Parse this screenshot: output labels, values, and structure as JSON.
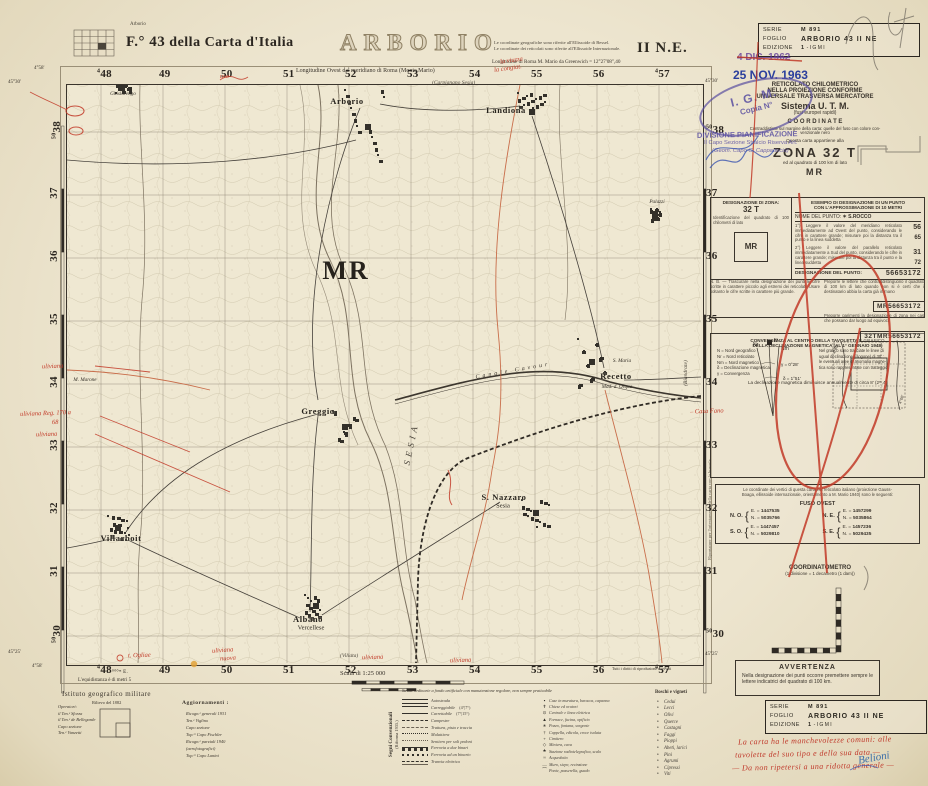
{
  "header": {
    "logo_label": "Arborio",
    "sheet_f": "F.° 43",
    "sheet_ref": "della Carta d'Italia",
    "title": "ARBORIO",
    "quadrant": "II N.E.",
    "note1": "Le coordinate geografiche sono riferite all'Ellissoide di Bessel.",
    "note2": "Le coordinate dei reticolati sono riferite all'Ellissoide Internazionale.",
    "lon_west": "Longitudine Ovest dal meridiano di Roma (Monte Mario)",
    "longitude": "Longitudine di Roma M. Mario da Greenwich = 12°27'08\",40"
  },
  "series_box": {
    "serie_label": "SERIE",
    "serie_value": "M 891",
    "foglio_label": "FOGLIO",
    "foglio_value": "ARBORIO 43 II NE",
    "edizione_label": "EDIZIONE",
    "edizione_value": "1",
    "edizione_suffix": "- I G M I"
  },
  "stamps": {
    "date_old": "4 DIC. 1962",
    "date_new": "25 NOV. 1963",
    "oval1": "I. G. M.",
    "oval2": "Copia N°",
    "divisione": "DIVISIONE PIANIFICAZIONE",
    "capo": "Il Capo Sezione Stralcio Riserva Art.",
    "firma": "(Geom. Capo C. Cappadocia)"
  },
  "utm_block": {
    "l1": "RETICOLATO CHILOMETRICO",
    "l2": "NELLA PROIEZIONE CONFORME",
    "l3": "UNIVERSALE TRASVERSA MERCATORE",
    "l4": "Sistema U. T. M.",
    "l5": "(fusi europei rapidi)",
    "l6": "C O O R D I N A T E",
    "l7": "Contraddistinte sul margine della carta: quelle del fuso con colore con-",
    "l8": "venzionale nero",
    "l9": "Questa carta appartiene alla",
    "zona": "ZONA 32 T",
    "sub": "ed al quadrato di 100 km di lato",
    "square": "MR"
  },
  "designation": {
    "h_left1": "DESIGNAZIONE DI ZONA:",
    "h_left2": "32 T",
    "h_left3": "Identificazione del quadrato di 100 chilometri di lato",
    "square": "MR",
    "h_right1": "ESEMPIO DI DESIGNAZIONE DI UN PUNTO",
    "h_right2": "CON L'APPROSSIMAZIONE DI 10 METRI",
    "nome_label": "NOME DEL PUNTO:",
    "nome_value": "✶ S.ROCCO",
    "p1": "1°) Leggere il valore del meridiano reticolato immediatamente ad Ovest del punto, considerando le cifre in carattere grande; misurare poi la distanza tra il punto e la linea suddetta",
    "p2": "2°) Leggere il valore del parallelo reticolato immediatamente a Sud del punto, considerando le cifre in carattere grande; misurare poi la distanza tra il punto e la linea suddetta",
    "n1": "56",
    "n2": "65",
    "n3": "31",
    "n4": "72",
    "res_label": "DESIGNAZIONE DEL PUNTO:",
    "res_value": "56653172",
    "nb": "N. B. — Trascurare nella designazione dei punti le cifre scritte in carattere piccolo agli estremi dei reticolati. Usare soltanto le cifre scritte in carattere più grande.",
    "nb1": "Preporre le lettere che contraddistinguono il quadrato di 100 km di lato quando non si è certi che il destinatario abbia la carta già in mano",
    "val1": "MR56653172",
    "nb2": "Preporre parimenti la designazione di zona nei casi che possano dar luogo ad equivoci",
    "val2": "32TMR56653172"
  },
  "declination": {
    "title1": "CONVERGENZA AL CENTRO DELLA TAVOLETTA E GRAFICO",
    "title2": "DELLA DECLINAZIONE MAGNETICA (AL 1° GENNAIO 1948)",
    "n_label": "N",
    "nr_label": "Nr",
    "nm_label": "Nm",
    "delta": "δ = 1°51'",
    "gamma": "γ = 0°28'",
    "chart_l1": "4°30'",
    "chart_l2": "4°00'",
    "legend_lines": [
      "N   =  Nord geografico",
      "Nr  =  Nord reticolato",
      "Nm =  Nord magnetico",
      "δ   =  Declinazione magnetica",
      "γ   =  Convergenza"
    ],
    "note_lines": [
      "Nel grafico sono tracciate le linee di",
      "ugual declinazione (isogone) di 30' ;",
      "le eventuali aree di anomalia magne-",
      "tica sono rappresentate con tratteggio."
    ],
    "bottom": "La declinazione magnetica diminuisce annualmente di circa 8' (2ᵐ,4)"
  },
  "fuso": {
    "intro1": "Le coordinate dei vertici di questa carta nel reticolato italiano (proiezione Gauss-",
    "intro2": "Boaga, ellissoide internazionale, orientamento a M. Mario 1940) sono le seguenti:",
    "title": "FUSO OVEST",
    "e_label": "E. =",
    "n_label": "N. =",
    "rows": [
      {
        "corner": "N. O.",
        "e": "1447535",
        "n": "5035766"
      },
      {
        "corner": "N. E.",
        "e": "1457299",
        "n": "5035864"
      },
      {
        "corner": "S. O.",
        "e": "1447457",
        "n": "5029810"
      },
      {
        "corner": "S. E.",
        "e": "1457236",
        "n": "5029435"
      }
    ]
  },
  "coordinatometro": {
    "title": "COORDINATOMETRO",
    "sub": "(1 divisione = 1 decametro (1 dam))"
  },
  "avvertenza": {
    "title": "AVVERTENZA",
    "text": "Nella designazione dei punti occorre premettere sempre le lettere indicatrici del quadrato di 100 km."
  },
  "bussola_note": "Riportatore per l'orientamento della carta con la bussola",
  "handwriting": {
    "lines": [
      "La carta ha le manchevolezze comuni: alle",
      "tavolette del suo tipo e della sua data —",
      "— Da non ripetersi a una ridotta generale —"
    ],
    "signature": "Belioni"
  },
  "credits": {
    "institute": "Istituto geografico militare",
    "col_left": [
      "Operatori:",
      "il Ten.ᵉ Sforza",
      "il Ten.ᵉ de Bellegarde",
      "",
      "Capo sezione",
      "Ten.ᵉ Vanzetti"
    ],
    "rilievo": "Rilievo del 1882",
    "agg_title": "Aggiornamenti :",
    "agg_lines": [
      "Ricogn.ᵉ generali 1931",
      "Ten.ᵉ Viglino",
      "Capo sezione",
      "Top.ʳᵉ Capo Fischler",
      "Ricogn.ᵉ parziali 1940",
      "(aerofotografici)",
      "Top.ʳᵉ Capo Lanini"
    ],
    "equidistanza": "L'equidistanza è di metri 5",
    "scala": "Scala di 1:25 000",
    "rights": "Tutti i diritti di riproduzione riservati",
    "segni1": "Segni Convenzionali",
    "segni2": "(Riforma 1935.)"
  },
  "legend": {
    "roads_header": "Strade ordinarie a fondo artificiale con manutenzione regolare, non sempre praticabile",
    "pendenze": [
      "(4°|7°)",
      "(7°|15°)"
    ],
    "roads": [
      "Autostrada",
      "Carreggiabile",
      "Carrettabile",
      "Campestre",
      "Trattura, pista e traccia",
      "Mulattiera",
      "Sentiero per soli pedoni",
      "Ferrovia a due binari",
      "Ferrovia ad un binario",
      "Tranvia elettrica"
    ],
    "symbols": [
      "Case in muratura, baracca, capanna",
      "Chiese ed oratori",
      "Centrale e linea elettrica",
      "Fornace, fucina, opificio",
      "Pozzo, fontana, sorgente",
      "Cappella, edicola, croce isolata",
      "Cimitero",
      "Miniera, cava",
      "Stazione radiotelegrafica, scalo",
      "Acquedotto",
      "Muro, siepe, recinzione",
      "Ponte, passerella, guado"
    ],
    "boschi_title": "Boschi e vigneti",
    "boschi": [
      "Cedui",
      "Lecci",
      "Olivi",
      "Querce",
      "Castagni",
      "Faggi",
      "Pioppi",
      "Abeti, larici",
      "Pini",
      "Agrumi",
      "Cipressi",
      "Viti"
    ]
  },
  "map": {
    "grid": {
      "top": [
        "48",
        "49",
        "50",
        "51",
        "52",
        "53",
        "54",
        "55",
        "56",
        "57"
      ],
      "bottom": [
        "48",
        "49",
        "50",
        "51",
        "52",
        "53",
        "54",
        "55",
        "56",
        "57"
      ],
      "left": [
        "38",
        "37",
        "36",
        "35",
        "34",
        "33",
        "32",
        "31",
        "30"
      ],
      "right": [
        "38",
        "37",
        "36",
        "35",
        "34",
        "33",
        "32",
        "31",
        "30"
      ],
      "sup_ew": "4",
      "sup_ns": "50",
      "bottom_suffix": "⁰⁰⁰ᵐ E."
    },
    "corners": {
      "tl_lon": "4°58'",
      "tl_lat": "45°30'",
      "tr_lat": "45°30'",
      "bl_lat": "45°25'",
      "bl_lon": "4°58'",
      "br_lat": "45°25'"
    },
    "adjacent": {
      "top": "(Carpignano Sesia)",
      "right": "(Biandrate)",
      "bottom": "(Villata)"
    },
    "places": [
      {
        "name": "Arborio",
        "x": 347,
        "y": 101,
        "cls": "town"
      },
      {
        "name": "Landiona",
        "x": 506,
        "y": 110,
        "cls": "town"
      },
      {
        "name": "Recetto",
        "x": 616,
        "y": 376,
        "cls": "town"
      },
      {
        "name": "Greggio",
        "x": 318,
        "y": 411,
        "cls": "town"
      },
      {
        "name": "S. Nazzaro",
        "x": 504,
        "y": 497,
        "cls": "town"
      },
      {
        "name": "Sesia",
        "x": 503,
        "y": 506,
        "cls": "town-sub"
      },
      {
        "name": "Villarboit",
        "x": 121,
        "y": 538,
        "cls": "town"
      },
      {
        "name": "Albano",
        "x": 308,
        "y": 619,
        "cls": "town"
      },
      {
        "name": "Vercellese",
        "x": 311,
        "y": 628,
        "cls": "town-sub"
      },
      {
        "name": "M. Marone",
        "x": 85,
        "y": 380,
        "cls": "farm"
      },
      {
        "name": "Palazzi",
        "x": 657,
        "y": 202,
        "cls": "farm"
      },
      {
        "name": "Ghislarengo",
        "x": 123,
        "y": 94,
        "cls": "farm"
      },
      {
        "name": "S. Maria",
        "x": 622,
        "y": 361,
        "cls": "farm"
      },
      {
        "name": "Mad. d. Orqua",
        "x": 617,
        "y": 387,
        "cls": "farm"
      },
      {
        "name": "MR",
        "x": 346,
        "y": 271,
        "cls": "big-mr"
      },
      {
        "name": "SESIA",
        "x": 411,
        "y": 444,
        "cls": "river",
        "rot": -78
      },
      {
        "name": "Canale Cavour",
        "x": 513,
        "y": 371,
        "cls": "canal",
        "rot": -10
      },
      {
        "name": "(Biandrate)",
        "x": 686,
        "y": 373,
        "cls": "adj-rot",
        "rot": -90
      }
    ],
    "blobs": [
      [
        368,
        127,
        24,
        38
      ],
      [
        532,
        112,
        15,
        20
      ],
      [
        592,
        362,
        15,
        24
      ],
      [
        345,
        427,
        13,
        17
      ],
      [
        536,
        513,
        15,
        14
      ],
      [
        118,
        528,
        11,
        13
      ],
      [
        316,
        606,
        12,
        12
      ],
      [
        655,
        214,
        5,
        6
      ],
      [
        122,
        88,
        8,
        5
      ]
    ],
    "annotations": [
      {
        "text": "uliviana",
        "x": 42,
        "y": 363
      },
      {
        "text": "uliviana Reg. 170 a",
        "x": 20,
        "y": 410
      },
      {
        "text": "68",
        "x": 52,
        "y": 419
      },
      {
        "text": "uliviana",
        "x": 36,
        "y": 431
      },
      {
        "text": "la viuzza",
        "x": 500,
        "y": 57,
        "rot": -8
      },
      {
        "text": "la congiat.",
        "x": 494,
        "y": 65,
        "rot": -8
      },
      {
        "text": "uso",
        "x": 220,
        "y": 73
      },
      {
        "text": "t. Ogliae",
        "x": 128,
        "y": 652
      },
      {
        "text": "uliviana",
        "x": 212,
        "y": 647,
        "rot": -4
      },
      {
        "text": "nuova",
        "x": 220,
        "y": 655,
        "rot": -4
      },
      {
        "text": "uliviana",
        "x": 362,
        "y": 654
      },
      {
        "text": "uliviana",
        "x": 450,
        "y": 657
      },
      {
        "text": "– Casa Fano",
        "x": 690,
        "y": 408
      }
    ]
  }
}
